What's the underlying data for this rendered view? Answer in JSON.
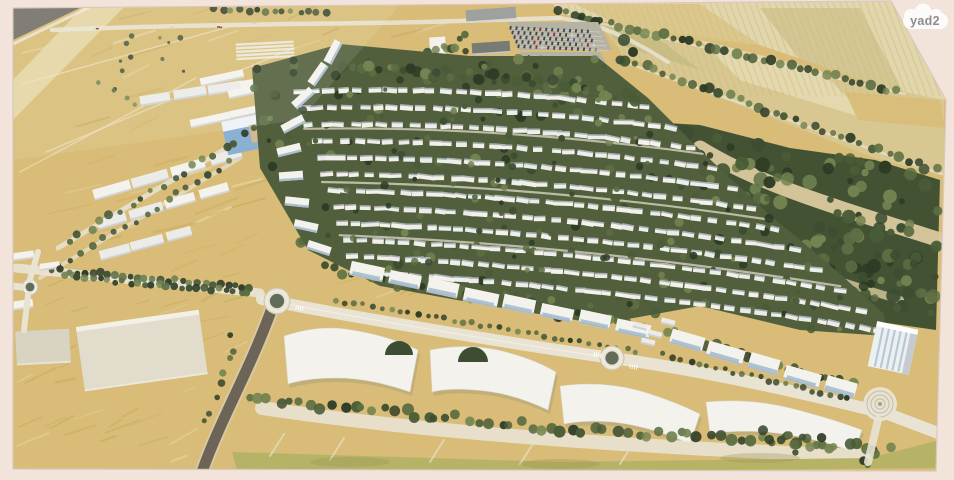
{
  "watermark": {
    "label": "yad2"
  },
  "palette": {
    "paper": "#f2e4db",
    "gold": "#d7ba72",
    "gold_dark": "#c6a254",
    "gold_pale": "#e8d9a8",
    "olive": "#b5b060",
    "road": "#e9e3d3",
    "road_shade": "#cfc8b4",
    "road_dark": "#665d50",
    "asphalt": "#6e6a62",
    "tree1": "#24321c",
    "tree2": "#33452a",
    "tree3": "#42552f",
    "tree4": "#55683b",
    "tree5": "#6e7f4a",
    "forest": "#394a2b",
    "sand": "#d9c89b",
    "white": "#f4f3ee",
    "white2": "#ebece9",
    "shade": "#b9bdc6",
    "glass": "#9db7cc",
    "blue_roof": "#86aed2",
    "gray_roof": "#9b9d99",
    "gray_dark": "#70756e",
    "ridge": "#5d6a79",
    "stripe": "#c9b87c",
    "tint1": "#d9c27f",
    "tint2": "#cdbd84",
    "tint3": "#e7dcb4",
    "tint4": "#b9b274",
    "ag_base": "#e2d5ab",
    "ag_base2": "#d7c68e",
    "green_center": "#5a6752",
    "car": "#3a3d42",
    "mall_shadow": "#8a8878",
    "grass_line": "#e6e0c8",
    "courtyard": "#d9b98a",
    "logo_bg": "#ffffff",
    "logo_text": "#8d8d90"
  }
}
